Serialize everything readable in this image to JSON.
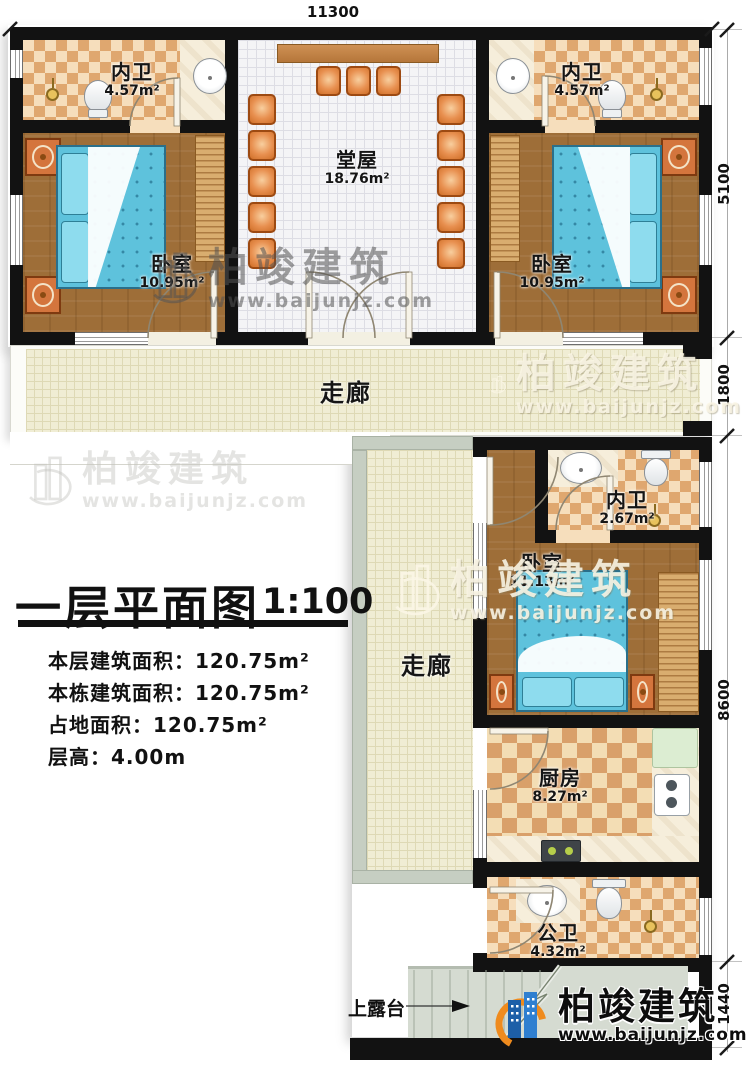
{
  "title_block": {
    "title": "一层平面图",
    "scale": "1:100",
    "info_lines": [
      "本层建筑面积：120.75m²",
      "本栋建筑面积：120.75m²",
      "占地面积：120.75m²",
      "层高：4.00m"
    ]
  },
  "dimensions": {
    "top_width": "11300",
    "right": [
      "5100",
      "1800",
      "8600",
      "1440"
    ]
  },
  "rooms": {
    "bath_top_left": {
      "name": "内卫",
      "area": "4.57m²"
    },
    "bath_top_right": {
      "name": "内卫",
      "area": "4.57m²"
    },
    "hall": {
      "name": "堂屋",
      "area": "18.76m²"
    },
    "bedroom_left": {
      "name": "卧室",
      "area": "10.95m²"
    },
    "bedroom_right": {
      "name": "卧室",
      "area": "10.95m²"
    },
    "corridor_top": {
      "name": "走廊"
    },
    "corridor_side": {
      "name": "走廊"
    },
    "bath_mid": {
      "name": "内卫",
      "area": "2.67m²"
    },
    "bedroom_lower": {
      "name": "卧室",
      "area": "11.13m²"
    },
    "kitchen": {
      "name": "厨房",
      "area": "8.27m²"
    },
    "bath_public": {
      "name": "公卫",
      "area": "4.32m²"
    }
  },
  "annotations": {
    "stairs": "上露台"
  },
  "watermark": {
    "brand": "柏竣建筑",
    "url": "www.baijunjz.com"
  },
  "logo": {
    "brand": "柏竣建筑",
    "url": "www.baijunjz.com"
  },
  "colors": {
    "wall": "#121212",
    "wood_floor": "#9e6e38",
    "tile_dark": "#dfa76f",
    "tile_light": "#f6debc",
    "bed_blue": "#5ec2dc",
    "furniture_orange": "#d4753d",
    "logo_blue": "#1d5fa8",
    "logo_orange": "#ef8b1e"
  }
}
